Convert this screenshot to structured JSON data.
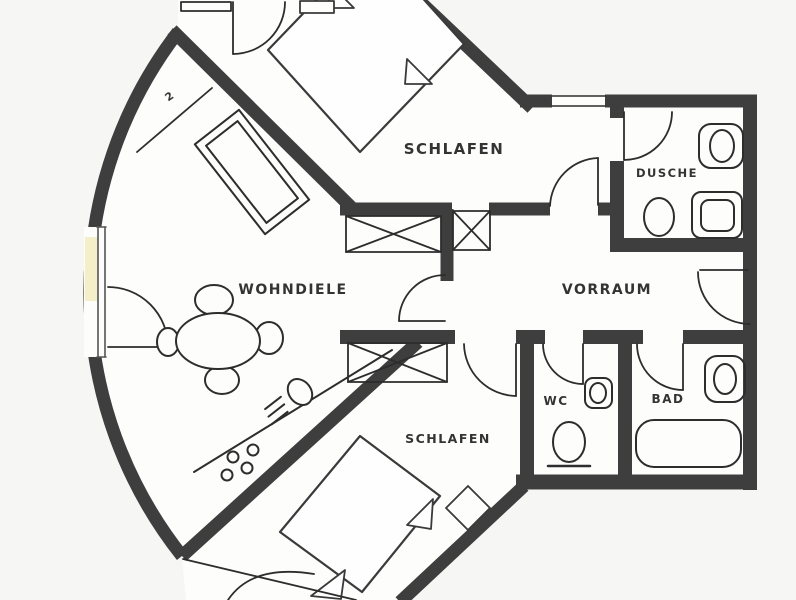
{
  "plan": {
    "title": "apartment-floor-plan",
    "rooms": [
      {
        "id": "bedroom-top",
        "label": "SCHLAFEN"
      },
      {
        "id": "living-dining",
        "label": "WOHNDIELE"
      },
      {
        "id": "hall",
        "label": "VORRAUM"
      },
      {
        "id": "shower-room",
        "label": "DUSCHE"
      },
      {
        "id": "wc",
        "label": "WC"
      },
      {
        "id": "bath",
        "label": "BAD"
      },
      {
        "id": "bedroom-bottom",
        "label": "SCHLAFEN"
      }
    ],
    "annotations": {
      "terrace_marker": "2"
    },
    "fixtures": {
      "bedroom_top": [
        "double-bed",
        "wardrobe-sideboard",
        "terrace-door"
      ],
      "living_dining": [
        "dining-table",
        "chairs-x4",
        "kitchen-counter",
        "sink",
        "cooktop-4-burners",
        "window-door"
      ],
      "hall": [
        "closet-x3"
      ],
      "shower_room": [
        "washbasin",
        "toilet",
        "shower"
      ],
      "wc": [
        "washbasin",
        "toilet"
      ],
      "bath": [
        "washbasin",
        "bathtub"
      ],
      "bedroom_bottom": [
        "double-bed",
        "nightstand"
      ]
    },
    "colors": {
      "wall": "#3e3e3e",
      "line": "#2d2d2d",
      "floor": "#fdfdfc",
      "outside": "#f6f6f4",
      "window_tint": "#f2ecbe"
    }
  }
}
